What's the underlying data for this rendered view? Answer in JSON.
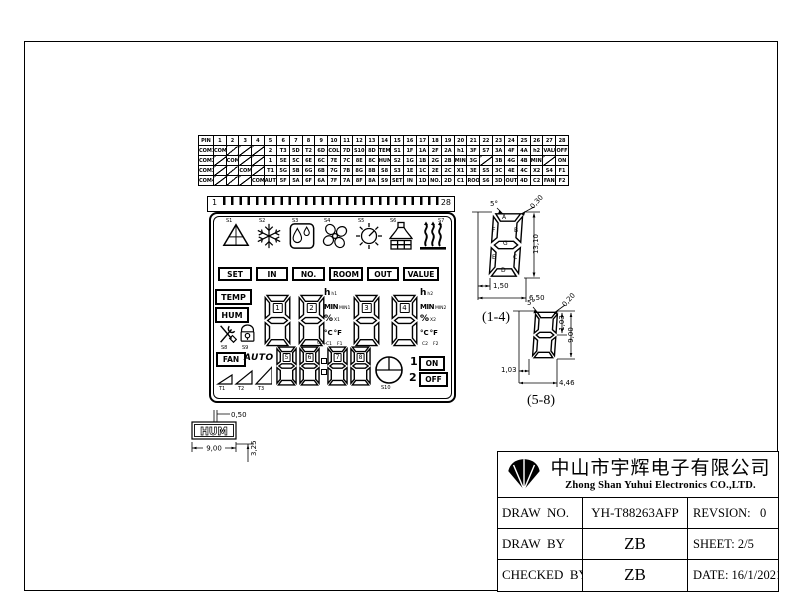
{
  "pin_table": {
    "header": [
      "PIN",
      "1",
      "2",
      "3",
      "4",
      "5",
      "6",
      "7",
      "8",
      "9",
      "10",
      "11",
      "12",
      "13",
      "14",
      "15",
      "16",
      "17",
      "18",
      "19",
      "20",
      "21",
      "22",
      "23",
      "24",
      "25",
      "26",
      "27",
      "28"
    ],
    "rows": [
      {
        "label": "COM1",
        "cells": [
          "COM1",
          "\\",
          "\\",
          "\\",
          "2",
          "T3",
          "5D",
          "T2",
          "6D",
          "COL",
          "7D",
          "S10",
          "8D",
          "TEMP",
          "S1",
          "1F",
          "1A",
          "2F",
          "2A",
          "h1",
          "3F",
          "S7",
          "3A",
          "4F",
          "4A",
          "h2",
          "VALUE",
          "OFF"
        ]
      },
      {
        "label": "COM2",
        "cells": [
          "\\",
          "COM2",
          "\\",
          "\\",
          "1",
          "5E",
          "5C",
          "6E",
          "6C",
          "7E",
          "7C",
          "8E",
          "8C",
          "HUM",
          "S2",
          "1G",
          "1B",
          "2G",
          "2B",
          "MIN1",
          "3G",
          "\\",
          "3B",
          "4G",
          "4B",
          "MIN2",
          "\\",
          "ON"
        ]
      },
      {
        "label": "COM3",
        "cells": [
          "\\",
          "\\",
          "COM3",
          "\\",
          "T1",
          "5G",
          "5B",
          "6G",
          "6B",
          "7G",
          "7B",
          "8G",
          "8B",
          "S8",
          "S3",
          "1E",
          "1C",
          "2E",
          "2C",
          "X1",
          "3E",
          "S5",
          "3C",
          "4E",
          "4C",
          "X2",
          "S4",
          "F1"
        ]
      },
      {
        "label": "COM4",
        "cells": [
          "\\",
          "\\",
          "\\",
          "COM4",
          "AUTO",
          "5F",
          "5A",
          "6F",
          "6A",
          "7F",
          "7A",
          "8F",
          "8A",
          "S9",
          "SET",
          "IN",
          "1D",
          "NO.",
          "2D",
          "C1",
          "ROOM",
          "S6",
          "3D",
          "OUT",
          "4D",
          "C2",
          "FAN",
          "F2"
        ]
      }
    ]
  },
  "lcd": {
    "pin_start": "1",
    "pin_end": "28",
    "symbols": [
      {
        "id": "S1",
        "icon": "triangle-icon"
      },
      {
        "id": "S2",
        "icon": "snowflake-icon"
      },
      {
        "id": "S3",
        "icon": "droplets-icon"
      },
      {
        "id": "S4",
        "icon": "fan-blades-icon"
      },
      {
        "id": "S5",
        "icon": "sun-icon"
      },
      {
        "id": "S6",
        "icon": "hood-icon"
      },
      {
        "id": "S7",
        "icon": "heat-icon"
      }
    ],
    "mode_labels": [
      {
        "label": "SET"
      },
      {
        "label": "IN"
      },
      {
        "label": "NO."
      },
      {
        "label": "ROOM"
      },
      {
        "label": "OUT"
      },
      {
        "label": "VALUE"
      }
    ],
    "temp_label": "TEMP",
    "hum_label": "HUM",
    "tools_id": "S8",
    "lock_id": "S9",
    "clock_id": "S10",
    "digits_large": [
      "1",
      "2",
      "3",
      "4"
    ],
    "digits_small": [
      "5",
      "6",
      "7",
      "8"
    ],
    "colon_label": "COL",
    "units_mid": {
      "h": "h",
      "h_id": "h1",
      "min": "MIN",
      "min_id": "MIN1",
      "pct": "%",
      "pct_id": "X1",
      "c": "°C",
      "c_id": "C1",
      "f": "°F",
      "f_id": "F1"
    },
    "units_right": {
      "h": "h",
      "h_id": "h2",
      "min": "MIN",
      "min_id": "MIN2",
      "pct": "%",
      "pct_id": "X2",
      "c": "°C",
      "c_id": "C2",
      "f": "°F",
      "f_id": "F2"
    },
    "fan_label": "FAN",
    "auto_label": "AUTO",
    "triangle_ids": [
      "T1",
      "T2",
      "T3"
    ],
    "timer_on": {
      "num": "1",
      "label": "ON"
    },
    "timer_off": {
      "num": "2",
      "label": "OFF"
    }
  },
  "dim_1_4": {
    "caption": "(1-4)",
    "angle": "5°",
    "corner_gap": "0,30",
    "height": "13,10",
    "seg_width": "1,50",
    "width": "6,50",
    "segments": [
      "A",
      "B",
      "C",
      "D",
      "E",
      "F",
      "G"
    ]
  },
  "dim_5_8": {
    "caption": "(5-8)",
    "angle": "5°",
    "corner_gap": "0,20",
    "seg_height": "1,03",
    "height": "9,00",
    "seg_width": "1,03",
    "width": "4,46"
  },
  "hum_detail": {
    "label": "HUM",
    "stroke_width": "0,50",
    "width": "9,00",
    "height": "3,25"
  },
  "title_block": {
    "company_cn": "中山市宇辉电子有限公司",
    "company_en": "Zhong Shan Yuhui Electronics CO.,LTD.",
    "fields": [
      {
        "label": "DRAW  NO.",
        "value": "YH-T88263AFP",
        "right": "REVSION:   0"
      },
      {
        "label": "DRAW  BY",
        "value": "ZB",
        "right": "SHEET: 2/5"
      },
      {
        "label": "CHECKED  BY",
        "value": "ZB",
        "right": "DATE: 16/1/2021"
      }
    ]
  },
  "colors": {
    "ink": "#000000",
    "paper": "#ffffff"
  }
}
